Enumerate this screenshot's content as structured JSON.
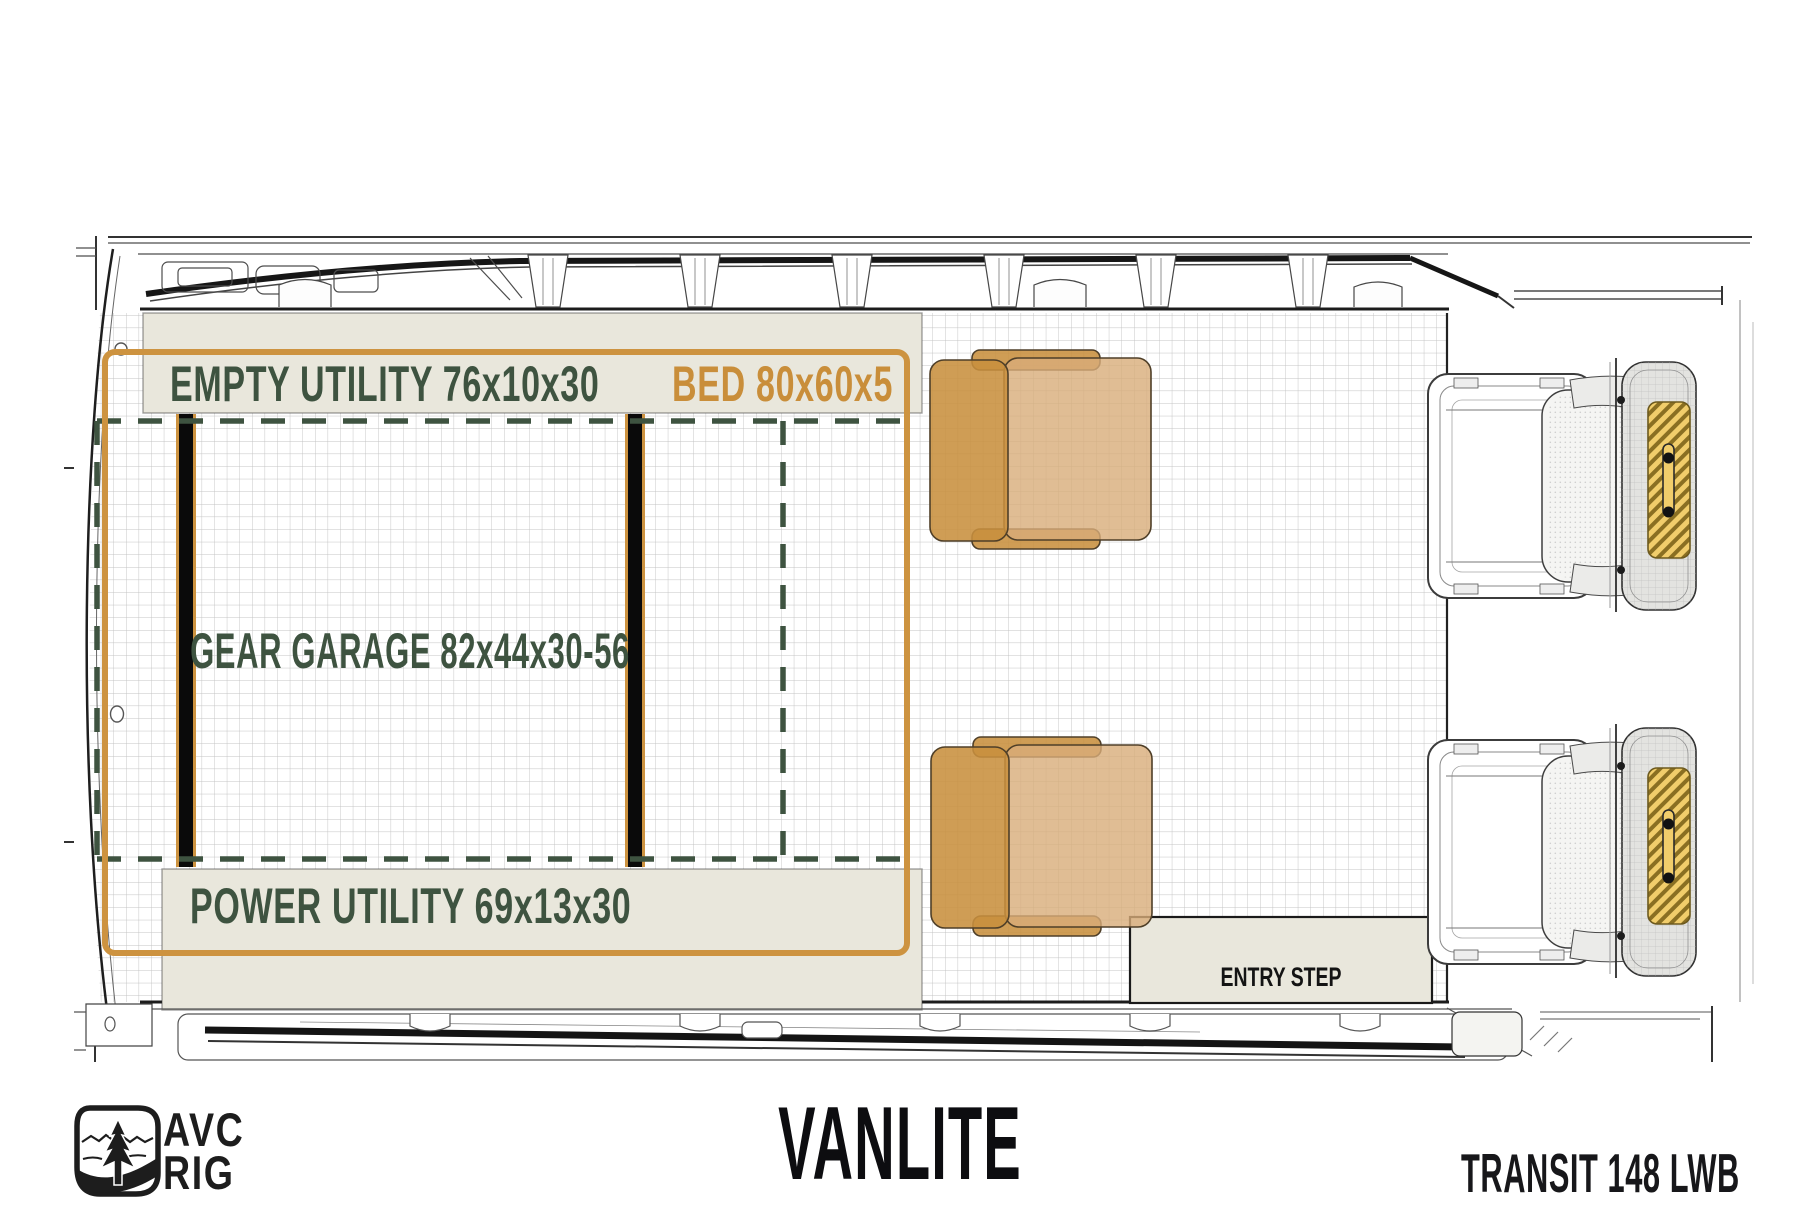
{
  "zones": {
    "empty_utility": {
      "label": "EMPTY UTILITY 76x10x30"
    },
    "bed": {
      "label": "BED 80x60x5"
    },
    "gear_garage": {
      "label": "GEAR GARAGE 82x44x30-56"
    },
    "power_utility": {
      "label": "POWER UTILITY 69x13x30"
    },
    "entry_step": {
      "label": "ENTRY STEP"
    }
  },
  "footer": {
    "title": "VANLITE",
    "model": "TRANSIT 148 LWB",
    "brand_top": "AVC",
    "brand_bottom": "RIG"
  },
  "colors": {
    "accent_orange": "#cd9340",
    "zone_green": "#3e5340",
    "panel_beige": "#e9e7dc",
    "chair_tan": "#c88f3e",
    "chair_tan_light": "#d8ad79",
    "headrest_yellow": "#f1cd6b"
  }
}
